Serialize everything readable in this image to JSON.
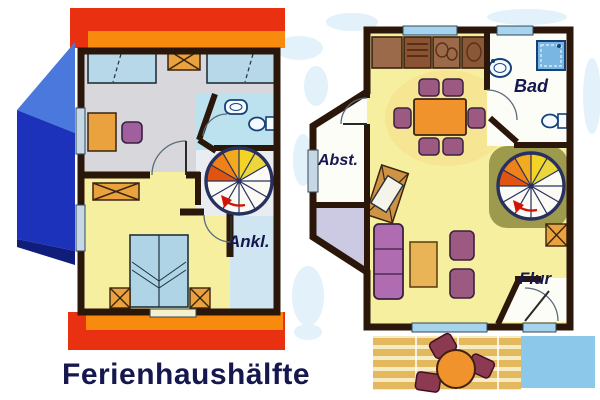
{
  "title": {
    "caption": "Ferienhaushälfte"
  },
  "plans": {
    "upper_floor": {
      "labels": {
        "dressing_room": "Ankl."
      }
    },
    "ground_floor": {
      "labels": {
        "bathroom": "Bad",
        "storage": "Abst.",
        "hallway": "Flur"
      }
    }
  },
  "colors": {
    "roof_red": "#e93112",
    "roof_orange": "#f88a0e",
    "wall_dark": "#2b160a",
    "floor_gray": "#d7d7dc",
    "floor_yellow": "#f7efa0",
    "floor_bathroom": "#bce2f0",
    "floor_dressing": "#cfe6f2",
    "floor_white": "#fdfdf8",
    "floor_entry_lavender": "#ccc9e2",
    "stair_mat_olive": "#9d9a4e",
    "house_blue_light": "#4a78dd",
    "house_blue_dark": "#1d32bb",
    "house_blue_deep": "#101d7a",
    "bed_blue": "#aed4e6",
    "furniture_orange": "#e9a23d",
    "table_orange": "#f0932c",
    "chair_plum": "#9c5a82",
    "sofa_purple": "#b06cb0",
    "wood_brown": "#9b6a4a",
    "deck_tan": "#e4b85c",
    "path_blue": "#8cc8ea",
    "window_blue": "#a6d4ee",
    "label_navy": "#17174f",
    "stair_yellow": "#f2d426",
    "stair_orange": "#f08018",
    "stair_red_orange": "#e05410",
    "arrow_red": "#cf1408"
  }
}
